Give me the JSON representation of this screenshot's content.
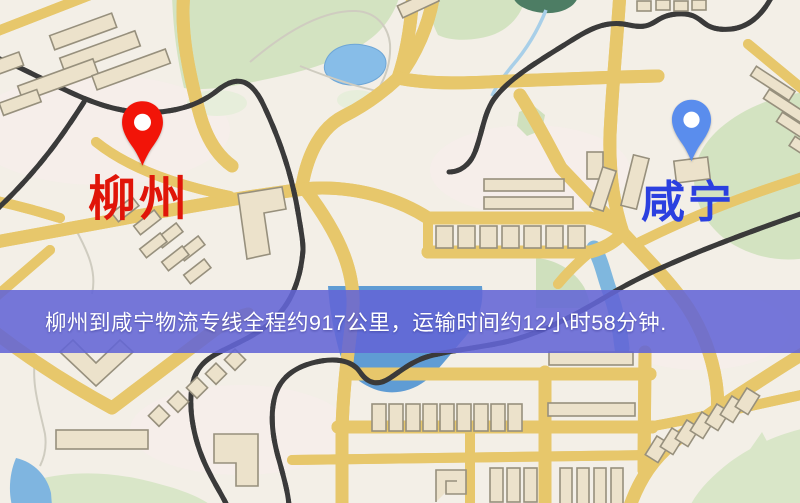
{
  "banner": {
    "text": "柳州到咸宁物流专线全程约917公里，运输时间约12小时58分钟.",
    "distance": "917公里",
    "duration": "12小时58分钟",
    "background_color": "#6365d6",
    "text_color": "#ffffff"
  },
  "markers": {
    "origin": {
      "name": "柳州",
      "pin_color": "#f21408",
      "label_color": "#e01509"
    },
    "destination": {
      "name": "咸宁",
      "pin_color": "#5a8ded",
      "label_color": "#2b40e0"
    }
  },
  "map": {
    "colors": {
      "background": "#f3efe7",
      "road_fill": "#f7da82",
      "road_casing": "#e7c76b",
      "park_green": "#d3e3c1",
      "water_blue": "#7fb5e0",
      "building_fill": "#ece2cb",
      "railway_dark": "#3a3a3a"
    }
  }
}
